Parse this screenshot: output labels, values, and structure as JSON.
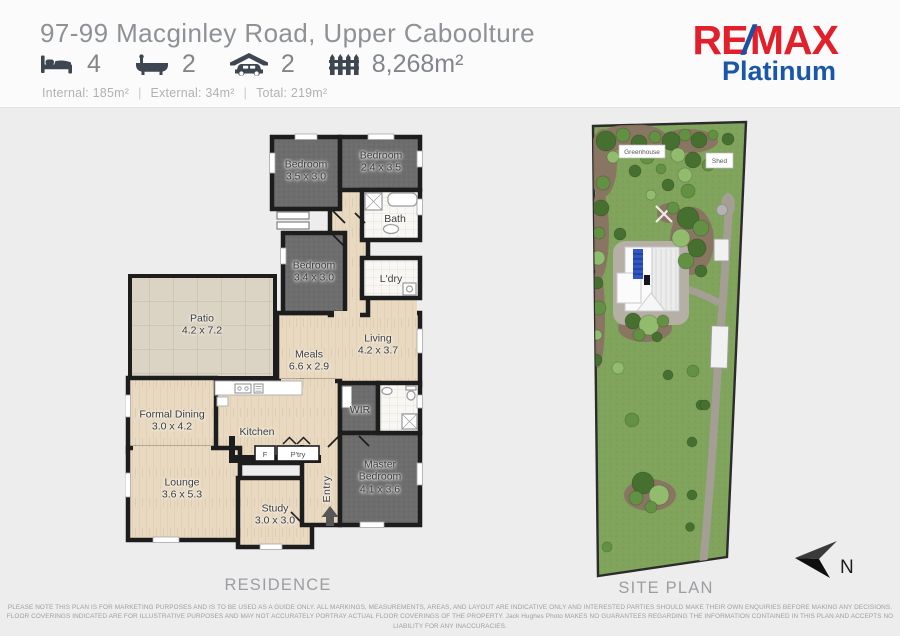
{
  "header": {
    "title": "97-99 Macginley Road, Upper Caboolture",
    "stats": [
      {
        "icon": "bed-icon",
        "value": "4"
      },
      {
        "icon": "bath-icon",
        "value": "2"
      },
      {
        "icon": "garage-icon",
        "value": "2"
      },
      {
        "icon": "land-icon",
        "value": "8,268m²"
      }
    ],
    "areas": {
      "internal": "Internal: 185m²",
      "external": "External: 34m²",
      "total": "Total:  219m²",
      "separator": "|"
    },
    "logo": {
      "re": "RE",
      "slash": "/",
      "max": "MAX",
      "sub": "Platinum"
    }
  },
  "colors": {
    "logo_red": "#E2202C",
    "logo_blue": "#1B4FA3",
    "wall": "#1d1d1d",
    "carpet": "#6d6d6d",
    "timber": "#e8d9c0",
    "patio": "#dbd3c3",
    "grass": "#80a45c"
  },
  "floorplan": {
    "section_label": "RESIDENCE",
    "rooms": [
      {
        "id": "bedroom-1",
        "name": "Bedroom",
        "dims": "3.5 x 3.0"
      },
      {
        "id": "bedroom-2",
        "name": "Bedroom",
        "dims": "2.4 x 3.5"
      },
      {
        "id": "bath",
        "name": "Bath",
        "dims": ""
      },
      {
        "id": "bedroom-3",
        "name": "Bedroom",
        "dims": "3.4 x 3.0"
      },
      {
        "id": "laundry",
        "name": "L'dry",
        "dims": ""
      },
      {
        "id": "patio",
        "name": "Patio",
        "dims": "4.2 x 7.2"
      },
      {
        "id": "meals",
        "name": "Meals",
        "dims": "6.6 x 2.9"
      },
      {
        "id": "living",
        "name": "Living",
        "dims": "4.2 x 3.7"
      },
      {
        "id": "wir",
        "name": "WIR",
        "dims": ""
      },
      {
        "id": "master-bedroom",
        "name": "Master Bedroom",
        "dims": "4.1 x 3.6"
      },
      {
        "id": "formal-dining",
        "name": "Formal Dining",
        "dims": "3.0 x 4.2"
      },
      {
        "id": "kitchen",
        "name": "Kitchen",
        "dims": ""
      },
      {
        "id": "lounge",
        "name": "Lounge",
        "dims": "3.6 x 5.3"
      },
      {
        "id": "study",
        "name": "Study",
        "dims": "3.0 x 3.0"
      },
      {
        "id": "entry",
        "name": "Entry",
        "dims": ""
      }
    ],
    "fixtures": {
      "fridge": "F",
      "pantry": "P'try"
    }
  },
  "siteplan": {
    "section_label": "SITE PLAN",
    "greenhouse_label": "Greenhouse",
    "shed_label": "Shed",
    "north_label": "N"
  },
  "footer": {
    "disclaimer_line1": "PLEASE NOTE THIS PLAN IS FOR MARKETING PURPOSES AND IS TO BE USED AS A GUIDE ONLY.  ALL MARKINGS, MEASUREMENTS, AREAS, AND LAYOUT ARE INDICATIVE ONLY AND INTERESTED PARTIES SHOULD MAKE THEIR OWN ENQUIRIES BEFORE MAKING ANY DECISIONS.",
    "disclaimer_line2": "FLOOR COVERINGS INDICATED ARE FOR ILLUSTRATIVE PURPOSES AND MAY NOT ACCURATELY PORTRAY ACTUAL FLOOR COVERINGS OF THE PROPERTY.  Jack Hughes Photo MAKES NO GUARANTEES REGARDING THE INFORMATION CONTAINED IN THIS PLAN AND ACCEPTS NO LIABILITY FOR  ANY INACCURACIES."
  }
}
